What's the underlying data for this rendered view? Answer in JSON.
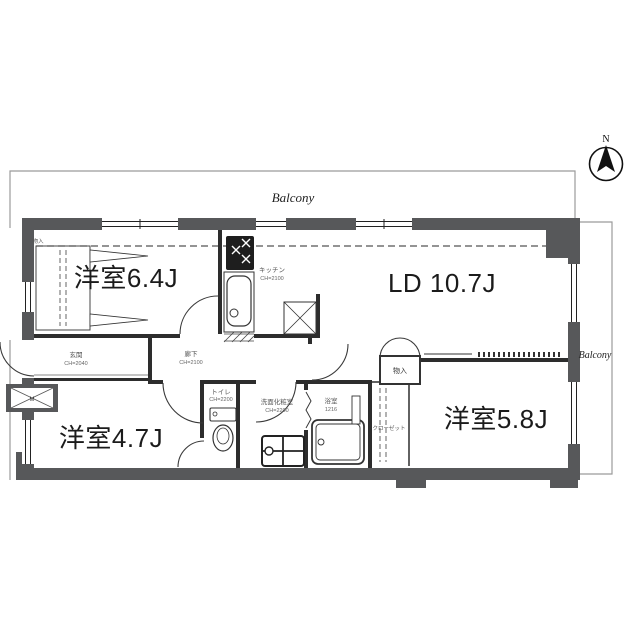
{
  "plan": {
    "compass": {
      "north_label": "N"
    },
    "balconies": {
      "top_label": "Balcony",
      "right_label": "Balcony"
    },
    "rooms": {
      "western_room_1": {
        "label": "洋室6.4J"
      },
      "living_dining": {
        "label": "LD 10.7J"
      },
      "western_room_2": {
        "label": "洋室4.7J"
      },
      "western_room_3": {
        "label": "洋室5.8J"
      },
      "kitchen": {
        "label": "キッチン",
        "ceiling": "CH=2100"
      },
      "entrance": {
        "label": "玄関",
        "ceiling": "CH=2040"
      },
      "hallway": {
        "label": "廊下",
        "ceiling": "CH=2100"
      },
      "toilet": {
        "label": "トイレ",
        "ceiling": "CH=2200"
      },
      "washroom": {
        "label": "洗面化粧室",
        "ceiling": "CH=2200"
      },
      "bathroom": {
        "label": "浴室",
        "size": "1216"
      },
      "storage_living": {
        "label": "物入"
      },
      "storage_bedroom1": {
        "label": "物入"
      },
      "closet": {
        "label": "クローゼット"
      },
      "meter_box": {
        "label": "M"
      }
    },
    "colors": {
      "wall": "#57585a",
      "interior_line": "#2d2d2d",
      "balcony_line": "#9b9b9b",
      "small_text": "#555555",
      "room_text": "#1b1b1b",
      "background": "#ffffff"
    }
  }
}
